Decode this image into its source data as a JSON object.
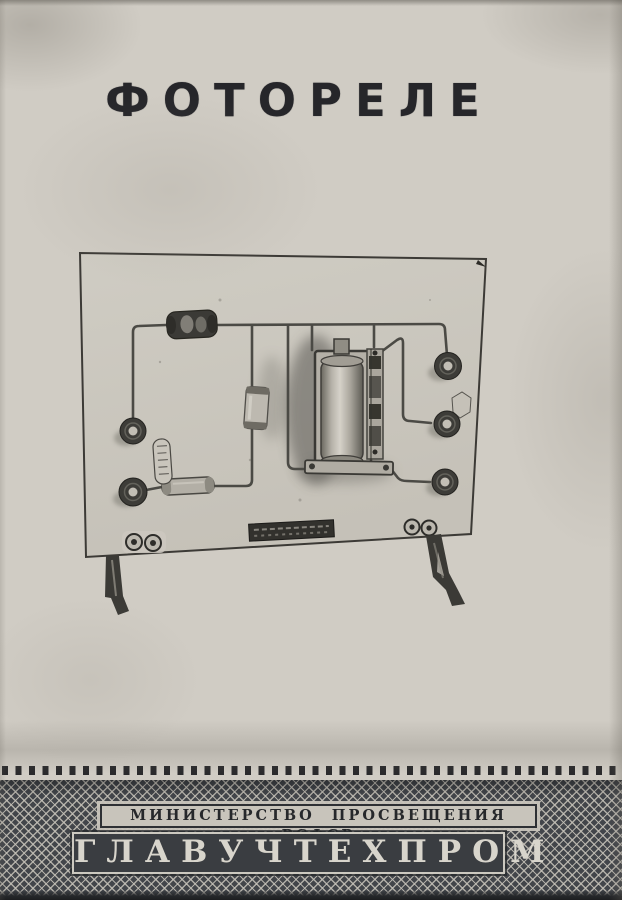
{
  "page": {
    "title": "ФОТОРЕЛЕ"
  },
  "figure": {
    "alt": "photorelay-chassis-photograph"
  },
  "footer": {
    "ministry_line": "МИНИСТЕРСТВО ПРОСВЕЩЕНИЯ РСФСР",
    "organization": "ГЛАВУЧТЕХПРОМ"
  },
  "colors": {
    "paper": "#d0ccc4",
    "ink": "#26262a",
    "band_bg": "#42454a",
    "band_line": "#c4c0b7",
    "plate_light": "#c8c4bb",
    "plate_dark": "#3a3d41",
    "org_text": "#d8d5cc"
  }
}
